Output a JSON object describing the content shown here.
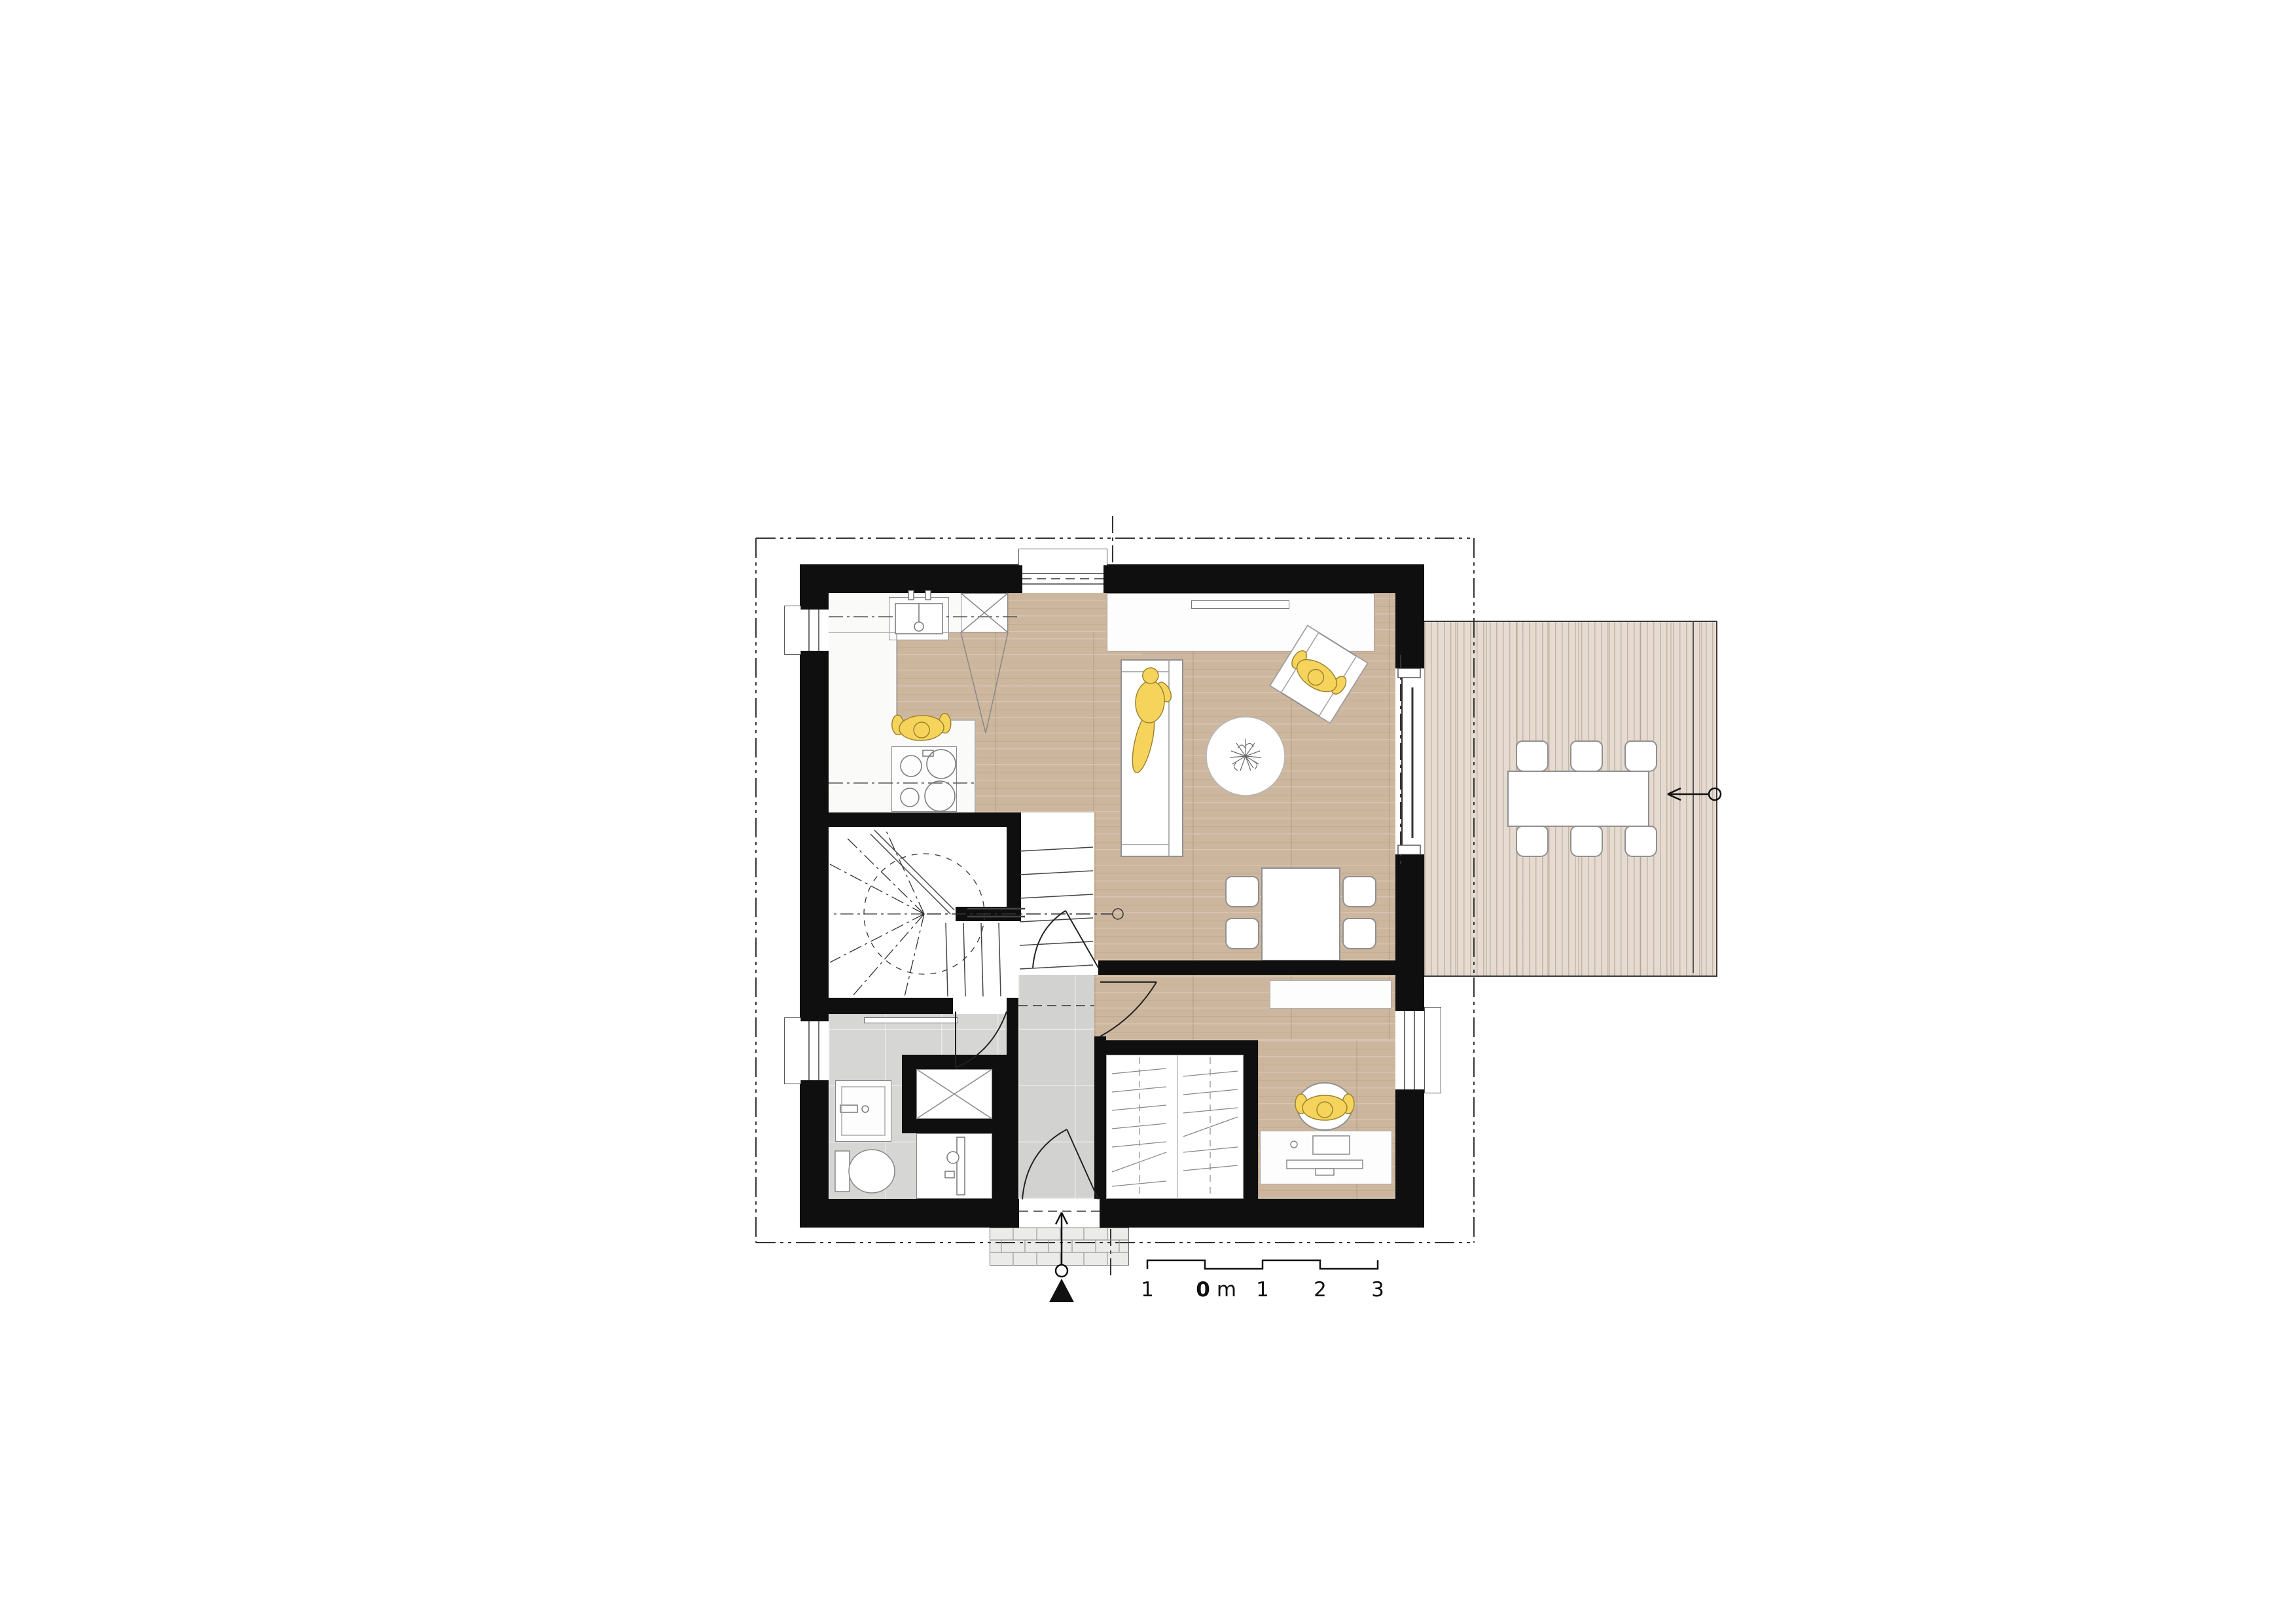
{
  "drawing": {
    "type": "architectural-floor-plan",
    "floor": "ground-floor",
    "background": "#ffffff"
  },
  "colors": {
    "wall": "#0f0f0f",
    "wood_floor": "#cdb69e",
    "deck_floor": "#e6dbd1",
    "tile_floor": "#d2d3d1",
    "person_accent": "#f6d45c",
    "furniture_outline": "#909090",
    "boundary_line": "#333333"
  },
  "scale_bar": {
    "unit": "m",
    "items": [
      {
        "text": "1",
        "bold": false
      },
      {
        "text": "0",
        "bold": true
      },
      {
        "text": "m",
        "bold": false
      },
      {
        "text": "1",
        "bold": false
      },
      {
        "text": "2",
        "bold": false
      },
      {
        "text": "3",
        "bold": false
      }
    ]
  },
  "icons": {
    "north_marker": "filled-triangle-up",
    "entrance_arrow": "arrow-up-with-circle",
    "section_arrow": "arrow-left-with-circle",
    "stair_reference": "dash-dot-line-with-circle",
    "shower": "crossed-square",
    "tall_cabinet": "crossed-square",
    "plant": "leaf-scribble"
  },
  "figures": [
    {
      "name": "person-cooking",
      "room": "kitchen"
    },
    {
      "name": "person-lying-on-sofa",
      "room": "living-room"
    },
    {
      "name": "person-in-armchair",
      "room": "living-room"
    },
    {
      "name": "person-at-desk",
      "room": "office"
    }
  ]
}
